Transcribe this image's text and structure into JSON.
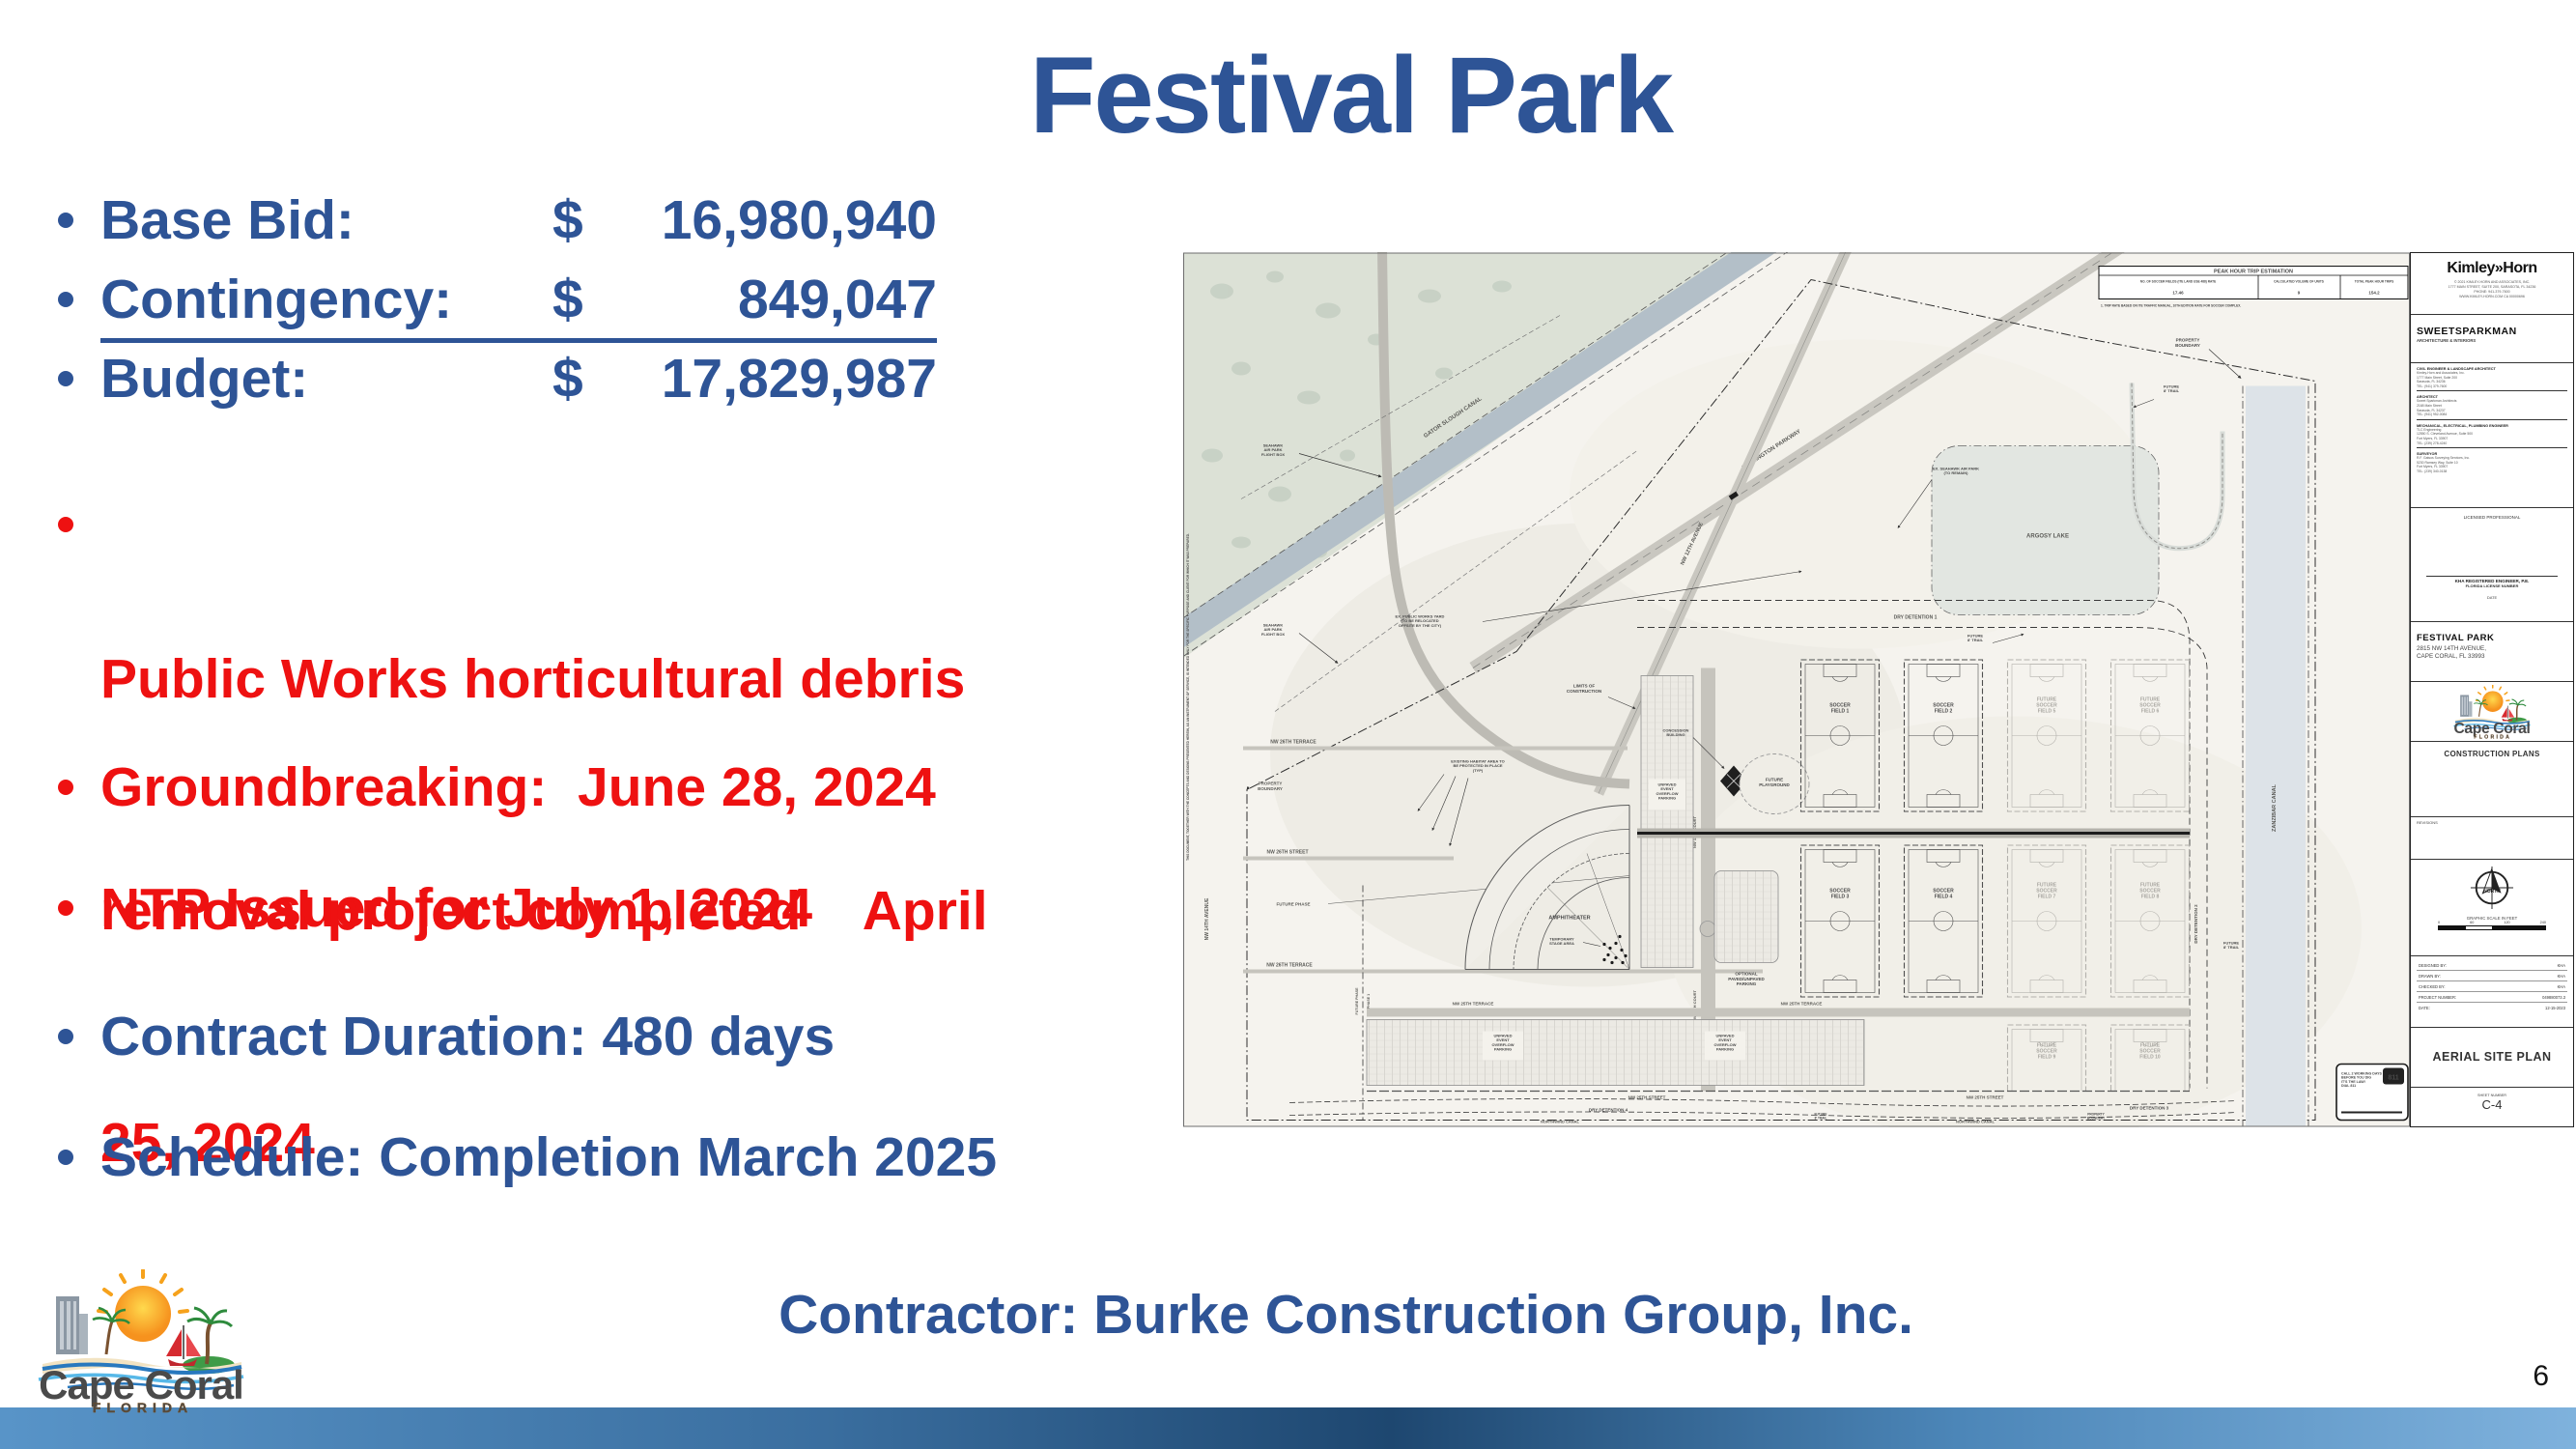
{
  "slide": {
    "title": "Festival Park",
    "page_number": "6",
    "contractor_line": "Contractor: Burke Construction Group, Inc.",
    "financial": [
      {
        "label": "Base Bid:",
        "currency": "$",
        "amount": "16,980,940"
      },
      {
        "label": "Contingency:",
        "currency": "$",
        "amount": "849,047"
      },
      {
        "label": "Budget:",
        "currency": "$",
        "amount": "17,829,987"
      }
    ],
    "bullets": [
      {
        "color": "red",
        "lines": [
          "Public Works horticultural debris",
          "removal project completed    April",
          "25, 2024"
        ]
      },
      {
        "color": "red",
        "lines": [
          "Groundbreaking:  June 28, 2024"
        ]
      },
      {
        "color": "red",
        "lines": [
          "NTP Issued for July 1, 2024"
        ]
      },
      {
        "color": "blue",
        "lines": [
          "Contract Duration: 480 days"
        ]
      },
      {
        "color": "blue",
        "lines": [
          "Schedule: Completion March 2025"
        ]
      }
    ],
    "colors": {
      "blue": "#2E5496",
      "red": "#EE1111"
    }
  },
  "logo": {
    "city": "Cape Coral",
    "state": "FLORIDA"
  },
  "site_plan": {
    "trip_table": {
      "title": "PEAK HOUR TRIP ESTIMATION",
      "cols": [
        "NO. OF SOCCER FIELDS (ITE LAND USE 488) RATE",
        "CALCULATED VOLUME OF UNITS",
        "TOTAL PEAK HOUR TRIPS"
      ],
      "vals": [
        "17.46",
        "9",
        "154.2"
      ],
      "note": "1.   TRIP RATE BASED ON ITE TRAFFIC MANUAL, 10TH EDITION RATE FOR SOCCER COMPLEX."
    },
    "labels": {
      "gator_canal": "GATOR SLOUGH CANAL",
      "wilmington": "WILMINGTON PARKWAY",
      "nw12_ave": "NW 12TH AVENUE",
      "nw14_ave": "NW 14TH AVENUE",
      "nw13_ct": "NW 13TH COURT",
      "seahawk": [
        "SEAHAWK",
        "AIR PARK",
        "FLIGHT BOX"
      ],
      "seahawk_remain": [
        "EX. SEAHAWK AIR PARK",
        "(TO REMAIN)"
      ],
      "public_works": [
        "EX. PUBLIC WORKS YARD",
        "(TO BE RELOCATED",
        "OFFSITE BY THE CITY)"
      ],
      "property_boundary": [
        "PROPERTY",
        "BOUNDARY"
      ],
      "future_trail": [
        "FUTURE",
        "8' TRAIL"
      ],
      "argosy": "ARGOSY LAKE",
      "dry1": "DRY DETENTION 1",
      "dry2": "DRY DETENTION 2",
      "dry3": "DRY DETENTION 3",
      "dry4": "DRY DETENTION  4",
      "zanzibar": "ZANZIBAR CANAL",
      "northwind": "NORTHWIND CANAL",
      "nw26_terrace": "NW 26TH TERRACE",
      "nw26_street": "NW 26TH STREET",
      "nw25_terrace": "NW 25TH TERRACE",
      "nw25_street": "NW 25TH STREET",
      "future_phase": "FUTURE PHASE",
      "phase1": "PHASE 1",
      "limits": [
        "LIMITS OF",
        "CONSTRUCTION"
      ],
      "habitat": [
        "EXISTING HABITAT AREA TO",
        "BE PROTECTED IN PLACE",
        "(TYP)"
      ],
      "amphitheater": "AMPHITHEATER",
      "temp_stage": [
        "TEMPORARY",
        "STAGE AREA"
      ],
      "unpaved": [
        "UNPAVED",
        "EVENT",
        "OVERFLOW",
        "PARKING"
      ],
      "optional_parking": [
        "OPTIONAL",
        "PAVED/UNPAVED",
        "PARKING"
      ],
      "concession": [
        "CONCESSION",
        "BUILDING"
      ],
      "playground": [
        "FUTURE",
        "PLAYGROUND"
      ],
      "fields": [
        [
          "SOCCER",
          "FIELD 1"
        ],
        [
          "SOCCER",
          "FIELD 2"
        ],
        [
          "SOCCER",
          "FIELD 3"
        ],
        [
          "SOCCER",
          "FIELD 4"
        ]
      ],
      "future_fields": [
        [
          "FUTURE",
          "SOCCER",
          "FIELD 5"
        ],
        [
          "FUTURE",
          "SOCCER",
          "FIELD 6"
        ],
        [
          "FUTURE",
          "SOCCER",
          "FIELD 7"
        ],
        [
          "FUTURE",
          "SOCCER",
          "FIELD 8"
        ],
        [
          "FUTURE",
          "SOCCER",
          "FIELD 9"
        ],
        [
          "FUTURE",
          "SOCCER",
          "FIELD 10"
        ]
      ],
      "call811": [
        "CALL 2 WORKING DAYS",
        "BEFORE YOU DIG",
        "IT'S THE LAW!",
        "DIAL 811"
      ],
      "dig811": "811",
      "edge_note": "THIS DOCUMENT, TOGETHER WITH THE CONCEPTS AND DESIGNS PRESENTED HEREIN, AS AN INSTRUMENT OF SERVICE, IS INTENDED ONLY FOR THE SPECIFIC PURPOSE AND CLIENT FOR WHICH IT WAS PREPARED."
    },
    "titleblock": {
      "firm": "Kimley»Horn",
      "firm_lines": [
        "© 2021 KIMLEY-HORN AND ASSOCIATES, INC.",
        "1777 MAIN STREET, SUITE 200, SARASOTA, FL 34236",
        "PHONE: 941-379-7600",
        "WWW.KIMLEY-HORN.COM    CA 00000696"
      ],
      "arch": "SWEETSPARKMAN",
      "arch_sub": "ARCHITECTURE & INTERIORS",
      "consultants": [
        {
          "role": "CIVIL ENGINEER & LANDSCAPE ARCHITECT",
          "lines": [
            "Kimley-Horn and Associates, Inc.",
            "1777 Main Street, Suite 200",
            "Sarasota, FL 34236",
            "TEL: (941) 379-7600"
          ]
        },
        {
          "role": "ARCHITECT",
          "lines": [
            "Sweet Sparkman Architects",
            "2168 Main Street",
            "Sarasota, FL 34237",
            "TEL: (941) 952-0084"
          ]
        },
        {
          "role": "MECHANICAL, ELECTRICAL, PLUMBING ENGINEER",
          "lines": [
            "TLC Engineering",
            "12550 S. Cleveland Avenue, Suite 500",
            "Fort Myers, FL 33907",
            "TEL: (239) 278-4240"
          ]
        },
        {
          "role": "SURVEYOR",
          "lines": [
            "R.F. Gatsos Surveying Services, Inc.",
            "5230 Ramsey Way, Suite 10",
            "Fort Myers, FL 33907",
            "TEL: (239) 340-0138"
          ]
        }
      ],
      "licensed": "LICENSED PROFESSIONAL",
      "pe_name": "KHA REGISTERED ENGINEER, P.E.",
      "pe_lic": "FLORIDA LICENSE NUMBER",
      "date_label": "DATE",
      "project": "FESTIVAL PARK",
      "address": [
        "2815 NW 14TH AVENUE,",
        "CAPE CORAL, FL 33993"
      ],
      "plans": "CONSTRUCTION PLANS",
      "revisions": "REVISIONS",
      "north": "NORTH",
      "scale": "GRAPHIC SCALE IN FEET",
      "scale_ticks": [
        "0",
        "60",
        "120",
        "240"
      ],
      "meta": [
        [
          "DESIGNED BY:",
          "KHA"
        ],
        [
          "DRAWN BY:",
          "KHA"
        ],
        [
          "CHECKED BY:",
          "KHA"
        ],
        [
          "PROJECT NUMBER:",
          "049880073.3"
        ],
        [
          "DATE:",
          "12-15-2023"
        ]
      ],
      "sheet_title": "AERIAL SITE PLAN",
      "sheet_label": "SHEET NUMBER",
      "sheet_no": "C-4"
    }
  }
}
